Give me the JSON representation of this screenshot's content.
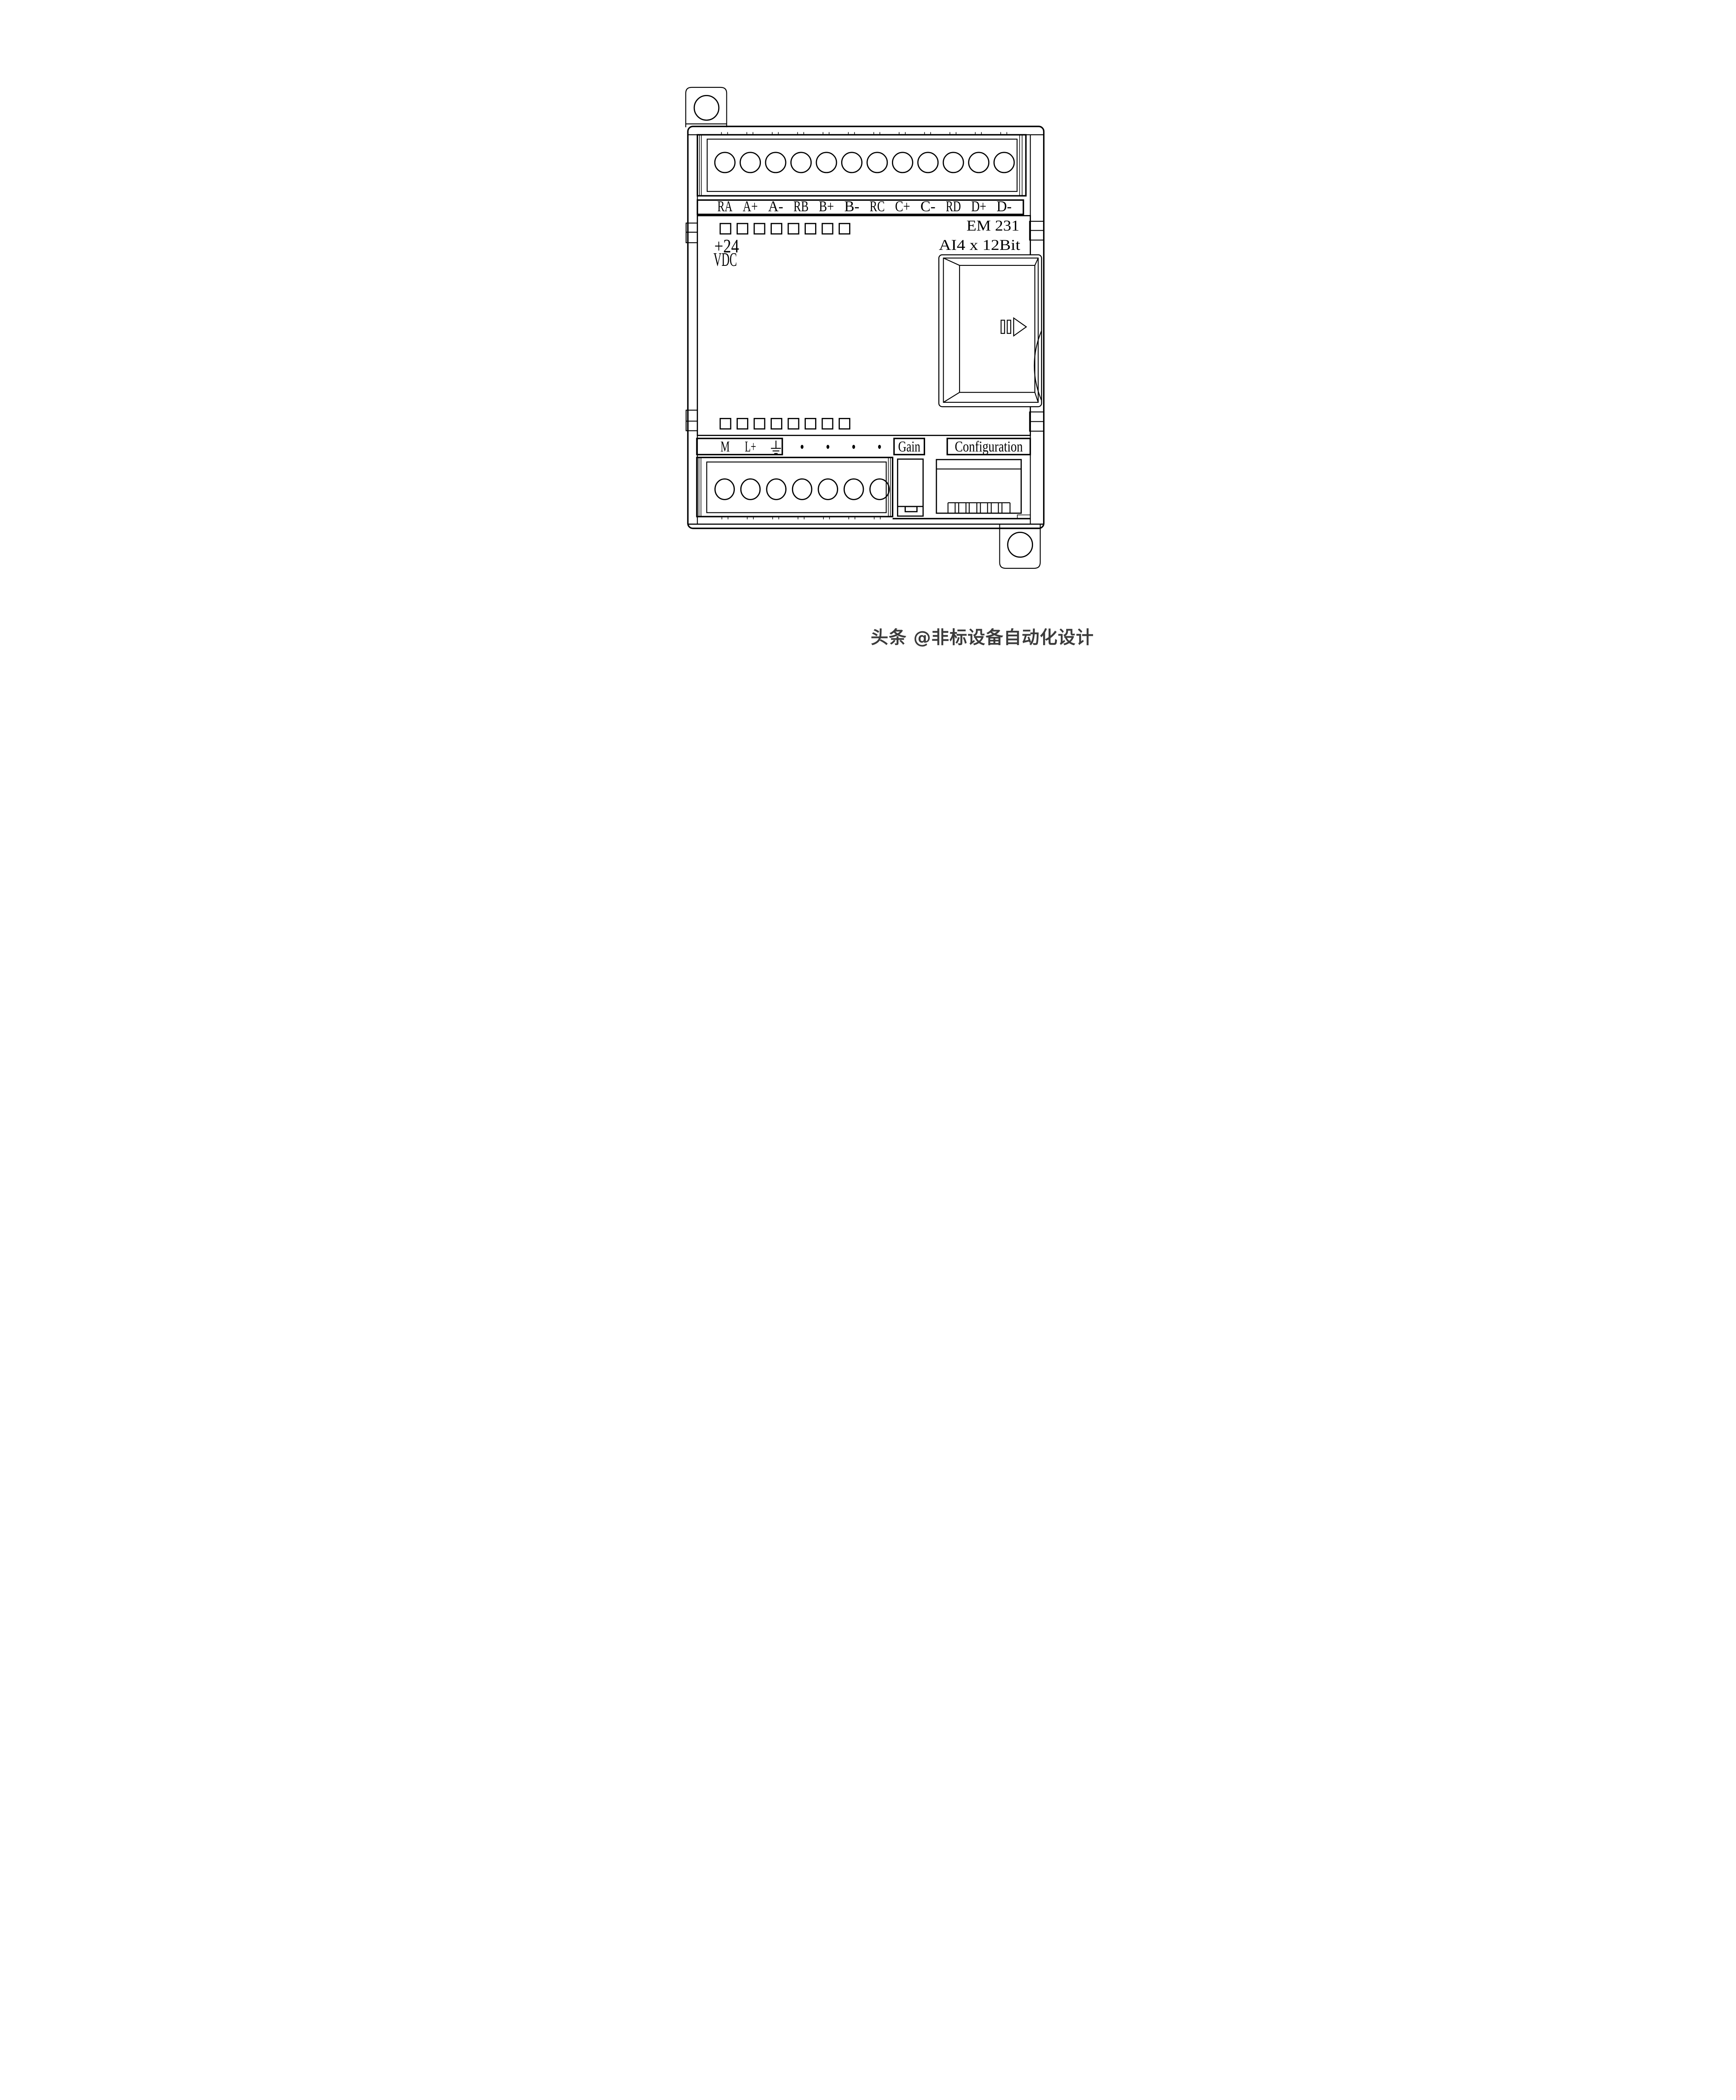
{
  "module": {
    "model": "EM 231",
    "spec": "AI4 x 12Bit",
    "power_line1": "+24",
    "power_line2": "VDC",
    "top_terminal_labels": [
      "RA",
      "A+",
      "A-",
      "RB",
      "B+",
      "B-",
      "RC",
      "C+",
      "C-",
      "RD",
      "D+",
      "D-"
    ],
    "bottom_terminal_labels": [
      "M",
      "L+"
    ],
    "gain_label": "Gain",
    "configuration_label": "Configuration",
    "top_terminal_count": 12,
    "bottom_terminal_count": 7,
    "indicator_count_top": 8,
    "indicator_count_bottom": 8,
    "unlabeled_terminal_dots": 4,
    "line_color": "#000000",
    "background_color": "#ffffff"
  },
  "watermark": {
    "text": "头条 @非标设备自动化设计",
    "color": "#3b3b3b"
  }
}
